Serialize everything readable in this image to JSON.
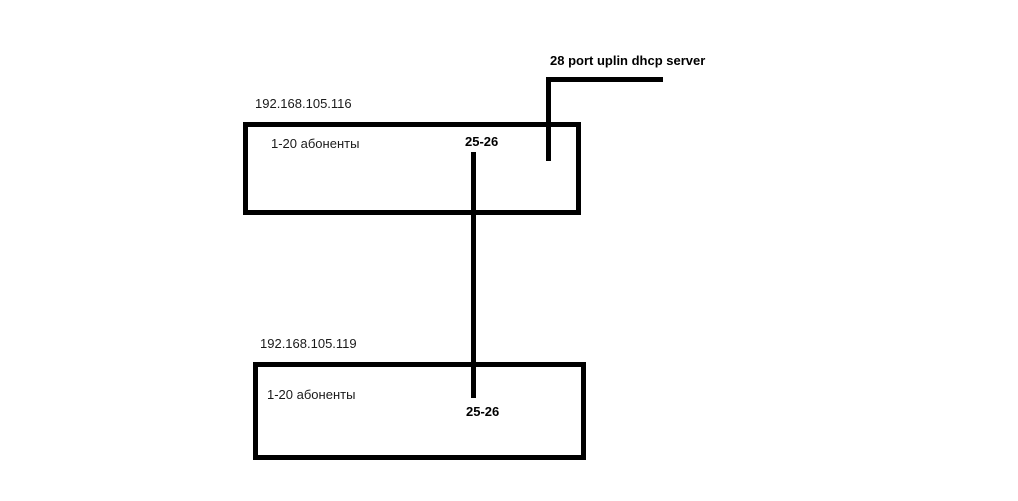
{
  "diagram": {
    "title": "",
    "uplink": {
      "label": "28 port uplin dhcp server"
    },
    "switch1": {
      "ip": "192.168.105.116",
      "ports_label": "1-20 абоненты",
      "trunk_label": "25-26"
    },
    "switch2": {
      "ip": "192.168.105.119",
      "ports_label": "1-20 абоненты",
      "trunk_label": "25-26"
    },
    "colors": {
      "line": "#000000",
      "text": "#1a1a1a",
      "background": "#ffffff"
    }
  }
}
